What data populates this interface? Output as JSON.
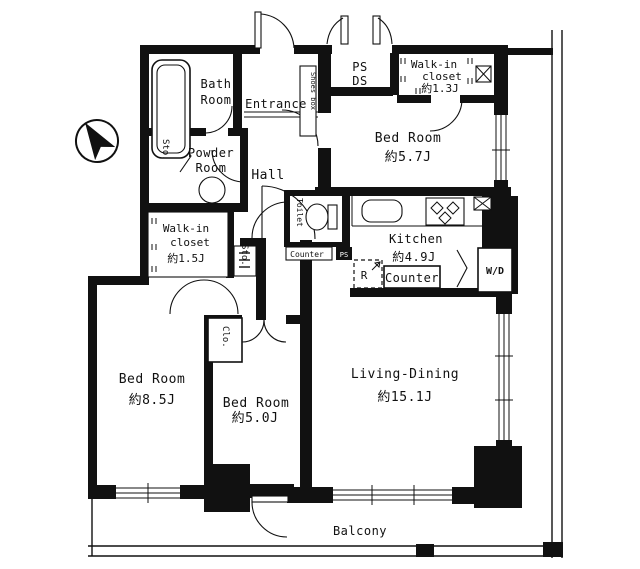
{
  "plan": {
    "type": "apartment-floor-plan",
    "colors": {
      "wall": "#111111",
      "background": "#ffffff"
    },
    "rooms": {
      "bath": {
        "line1": "Bath",
        "line2": "Room"
      },
      "entrance": {
        "label": "Entrance"
      },
      "shoes_box": {
        "label": "Shoes box"
      },
      "ps_ds": {
        "line1": "PS",
        "line2": "DS"
      },
      "walkin13": {
        "line1": "Walk-in",
        "line2": "closet",
        "area": "約1.3J"
      },
      "bedroom57": {
        "name": "Bed Room",
        "area": "約5.7J"
      },
      "powder": {
        "line1": "Powder",
        "line2": "Room"
      },
      "sto_upper": {
        "label": "Sto."
      },
      "hall": {
        "label": "Hall"
      },
      "toilet": {
        "label": "Toilet"
      },
      "toilet_counter": {
        "label": "Counter"
      },
      "ps_small": {
        "label": "PS"
      },
      "kitchen": {
        "name": "Kitchen",
        "area": "約4.9J"
      },
      "fridge": {
        "label": "R"
      },
      "counter": {
        "label": "Counter"
      },
      "wd": {
        "label": "W/D"
      },
      "walkin15": {
        "line1": "Walk-in",
        "line2": "closet",
        "area": "約1.5J"
      },
      "sto_mid": {
        "label": "Sto."
      },
      "clo": {
        "label": "Clo."
      },
      "bedroom85": {
        "name": "Bed Room",
        "area": "約8.5J"
      },
      "bedroom50": {
        "name": "Bed Room",
        "area": "約5.0J"
      },
      "living": {
        "name": "Living-Dining",
        "area": "約15.1J"
      },
      "balcony": {
        "label": "Balcony"
      }
    }
  }
}
